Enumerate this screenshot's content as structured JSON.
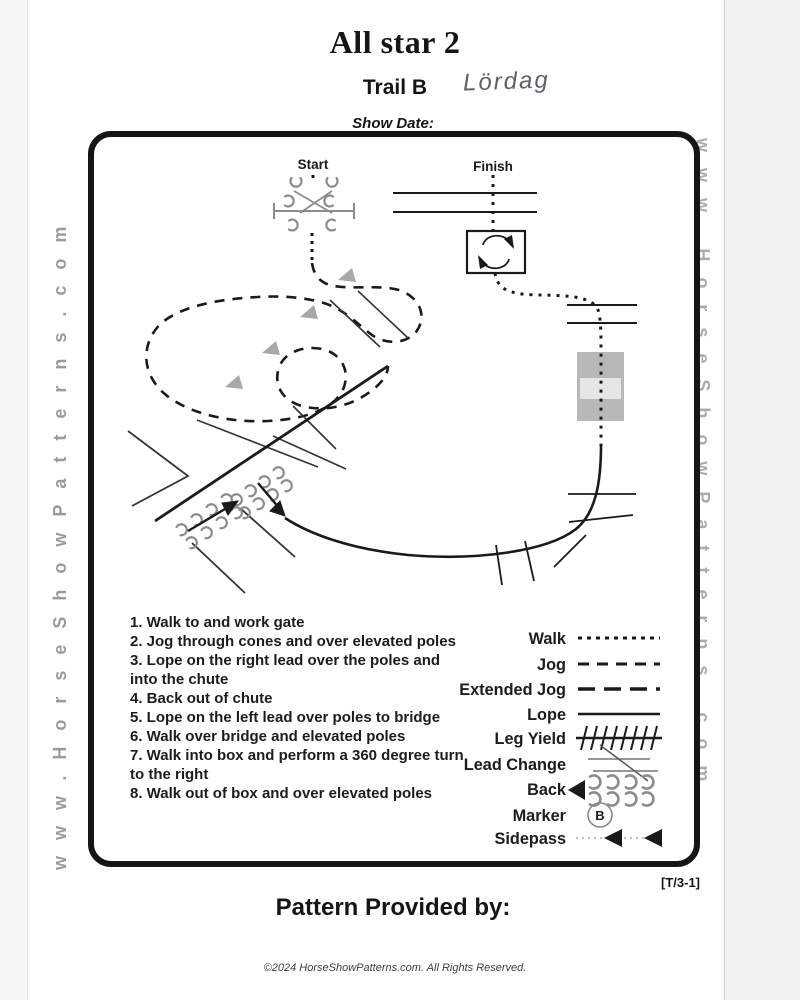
{
  "page": {
    "title": "All star 2",
    "subtitle": "Trail B",
    "handwritten_note": "Lördag",
    "show_date_label": "Show Date:",
    "pattern_code": "[T/3-1]",
    "pattern_provided_label": "Pattern Provided by:",
    "copyright": "©2024 HorseShowPatterns.com. All Rights Reserved.",
    "watermark_left": "www.HorseShowPatterns.com",
    "watermark_right": "www.HorseShowPatterns.com"
  },
  "diagram": {
    "start_label": "Start",
    "finish_label": "Finish"
  },
  "instructions": [
    "1. Walk to and work gate",
    "2. Jog through cones and over elevated poles",
    "3. Lope on the right lead over the poles and into the chute",
    "4. Back out of chute",
    "5. Lope on the left lead over poles to bridge",
    "6. Walk over bridge and elevated poles",
    "7. Walk into box and perform a 360 degree turn to the right",
    "8. Walk out of box and over elevated poles"
  ],
  "legend": {
    "marker_letter": "B",
    "items": [
      {
        "label": "Walk",
        "style": "dotted"
      },
      {
        "label": "Jog",
        "style": "dashed"
      },
      {
        "label": "Extended Jog",
        "style": "long-dash"
      },
      {
        "label": "Lope",
        "style": "solid"
      },
      {
        "label": "Leg Yield",
        "style": "ticked-line"
      },
      {
        "label": "Lead Change",
        "style": "crossed-lines"
      },
      {
        "label": "Back",
        "style": "hoofprints-arrow"
      },
      {
        "label": "Marker",
        "style": "circle-letter"
      },
      {
        "label": "Sidepass",
        "style": "dotted-arrows"
      }
    ]
  },
  "colors": {
    "ink": "#1a1a1a",
    "arena_border": "#151515",
    "gray_obstacle": "#8c8c8c",
    "cone": "#a8a8a8",
    "bridge": "#b8b8b8",
    "bridge_band": "#e6e6e6",
    "watermark": "#9b9b9b",
    "handwriting": "#5f5f66"
  }
}
